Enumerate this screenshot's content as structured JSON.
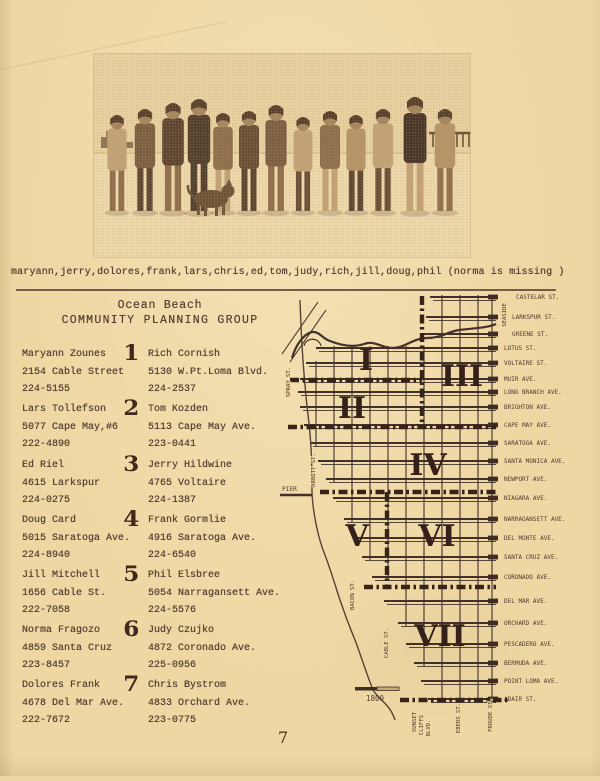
{
  "page": {
    "caption": "maryann,jerry,dolores,frank,lars,chris,ed,tom,judy,rich,jill,doug,phil (norma is missing )",
    "page_number": "7"
  },
  "header": {
    "title_line1": "Ocean Beach",
    "title_line2": "COMMUNITY PLANNING GROUP"
  },
  "photo": {
    "description": "thirteen group members standing arm-in-arm on the beach with a dog"
  },
  "directory": {
    "rows": [
      {
        "number": "1",
        "left": {
          "name": "Maryann Zounes",
          "address": "2154 Cable Street",
          "phone": "224-5155"
        },
        "right": {
          "name": "Rich Cornish",
          "address": "5130 W.Pt.Loma Blvd.",
          "phone": "224-2537"
        }
      },
      {
        "number": "2",
        "left": {
          "name": "Lars Tollefson",
          "address": "5077 Cape May,#6",
          "phone": "222-4890"
        },
        "right": {
          "name": "Tom Kozden",
          "address": "5113 Cape May Ave.",
          "phone": "223-0441"
        }
      },
      {
        "number": "3",
        "left": {
          "name": "Ed Riel",
          "address": "4615 Larkspur",
          "phone": "224-0275"
        },
        "right": {
          "name": "Jerry Hildwine",
          "address": "4765 Voltaire",
          "phone": "224-1387"
        }
      },
      {
        "number": "4",
        "left": {
          "name": "Doug Card",
          "address": "5015 Saratoga Ave.",
          "phone": "224-8940"
        },
        "right": {
          "name": "Frank Gormlie",
          "address": "4916 Saratoga Ave.",
          "phone": "224-6540"
        }
      },
      {
        "number": "5",
        "left": {
          "name": "Jill Mitchell",
          "address": "1656 Cable St.",
          "phone": "222-7058"
        },
        "right": {
          "name": "Phil Elsbree",
          "address": "5054 Narragansett Ave.",
          "phone": "224-5576"
        }
      },
      {
        "number": "6",
        "left": {
          "name": "Norma Fragozo",
          "address": "4859 Santa Cruz",
          "phone": "223-8457"
        },
        "right": {
          "name": "Judy Czujko",
          "address": "4872 Coronado Ave.",
          "phone": "225-0956"
        }
      },
      {
        "number": "7",
        "left": {
          "name": "Dolores Frank",
          "address": "4678 Del Mar Ave.",
          "phone": "222-7672"
        },
        "right": {
          "name": "Chris Bystrom",
          "address": "4833 Orchard Ave.",
          "phone": "223-0775"
        }
      }
    ]
  },
  "map": {
    "streets": [
      "CASTELAR ST.",
      "LARKSPUR ST.",
      "GREENE ST.",
      "LOTUS ST.",
      "VOLTAIRE ST.",
      "MUIR AVE.",
      "LONG BRANCH AVE.",
      "BRIGHTON AVE.",
      "CAPE MAY AVE.",
      "SARATOGA AVE.",
      "SANTA MONICA AVE.",
      "NEWPORT AVE.",
      "NIAGARA AVE.",
      "NARRAGANSETT AVE.",
      "DEL MONTE AVE.",
      "SANTA CRUZ AVE.",
      "CORONADO AVE.",
      "DEL MAR AVE.",
      "ORCHARD AVE.",
      "PESCADERO AVE.",
      "BERMUDA AVE.",
      "POINT LOMA AVE.",
      "ADAIR ST."
    ],
    "vertical_labels": [
      "SEASIDE",
      "SPRAY ST.",
      "ABBOTT ST.",
      "BACON ST.",
      "CABLE ST.",
      "SUNSET",
      "CLIFFS",
      "BLVD.",
      "EBERS ST.",
      "FROUDE ST."
    ],
    "districts": [
      "I",
      "II",
      "III",
      "IV",
      "V",
      "VI",
      "VII"
    ],
    "pier_label": "PIER",
    "scale_label": "1800"
  },
  "colors": {
    "paper": "#eed7a2",
    "ink": "#564135",
    "map_ink": "#3f2d24",
    "numeral_ink": "#36201a"
  }
}
